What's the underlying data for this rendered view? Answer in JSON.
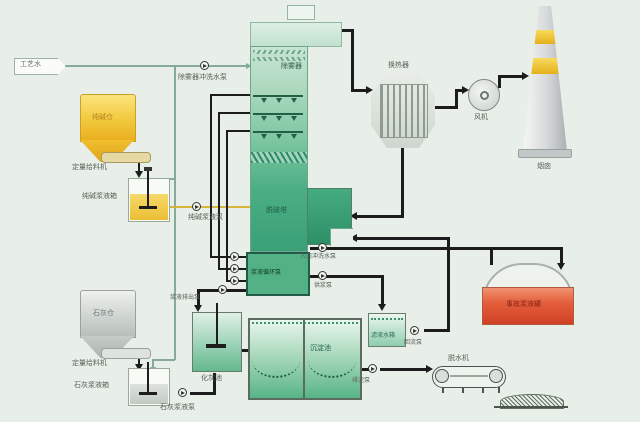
{
  "labels": {
    "process_water": "工艺水",
    "soda_silo": "纯碱仓",
    "feeder_top": "定量给料机",
    "soda_tank": "纯碱浆液箱",
    "soda_pump": "纯碱浆液泵",
    "me_wash_pump": "除雾器冲洗水泵",
    "mist_eliminator": "除雾器",
    "tower": "脱硫塔",
    "circ_pumps": "浆液循环泵",
    "discharge_pump": "浆液排出泵",
    "inlet_wash_pump": "入口冲洗水泵",
    "supply_pump": "供浆泵",
    "heat_exchanger": "换热器",
    "fan": "风机",
    "chimney": "烟囱",
    "emergency_tank": "事故浆液罐",
    "lime_silo": "石灰仓",
    "feeder_bottom": "定量给料机",
    "lime_tank": "石灰浆液箱",
    "lime_pump": "石灰浆液泵",
    "slaking_tank": "化灰池",
    "sedimentation_tank": "沉淀池",
    "filtrate_tank": "滤液水箱",
    "return_pump": "回流泵",
    "sludge_pump": "排泥泵",
    "dewaterer": "脱水机"
  },
  "colors": {
    "background": "#e8efe9",
    "tower_green": "#3aa077",
    "silo_yellow": "#f2c83c",
    "lime_gray": "#ccd2cd",
    "emergency_red": "#d03f24",
    "pipe_black": "#1c1c1c",
    "water_line": "#87ab9b"
  }
}
